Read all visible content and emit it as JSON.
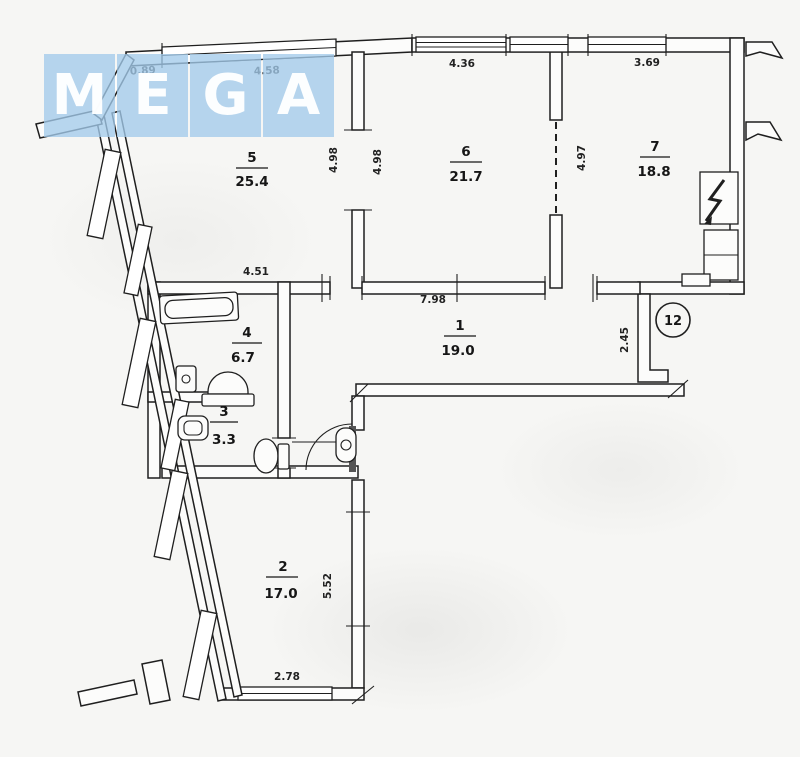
{
  "watermark": {
    "letters": [
      "M",
      "E",
      "G",
      "A"
    ]
  },
  "plan": {
    "stairwell_badge": "12",
    "rooms": [
      {
        "number": "1",
        "area": "19.0"
      },
      {
        "number": "2",
        "area": "17.0"
      },
      {
        "number": "3",
        "area": "3.3"
      },
      {
        "number": "4",
        "area": "6.7"
      },
      {
        "number": "5",
        "area": "25.4"
      },
      {
        "number": "6",
        "area": "21.7"
      },
      {
        "number": "7",
        "area": "18.8"
      }
    ],
    "dimensions": {
      "top_left": "0.89",
      "top_room5": "4.58",
      "top_room6": "4.36",
      "top_room7": "3.69",
      "room5_height": "4.98",
      "room6_height": "4.98",
      "room7_height": "4.97",
      "room4_width": "4.51",
      "hall_width": "7.98",
      "hall_right_height": "2.45",
      "room2_height": "5.52",
      "room2_width": "2.78"
    }
  }
}
